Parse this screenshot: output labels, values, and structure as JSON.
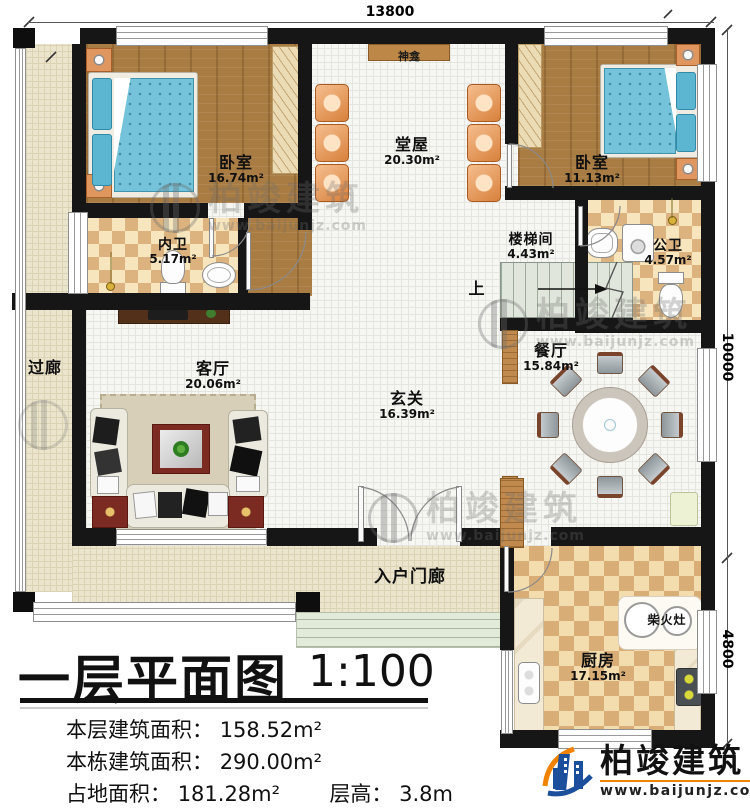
{
  "colors": {
    "wall": "#161616",
    "wood_floor": "#a87c42",
    "tile_light": "#f6e5bd",
    "tile_dark": "#dcb27f",
    "mattress_blue": "#74c3da",
    "logo_blue": "#1b4e9b",
    "logo_orange": "#f08300"
  },
  "dimensions": {
    "top": "13800",
    "right_upper": "10000",
    "right_lower": "4800"
  },
  "rooms": {
    "shrine": {
      "name": "神龛"
    },
    "hall": {
      "name": "堂屋",
      "area": "20.30m²"
    },
    "bedroom_left": {
      "name": "卧室",
      "area": "16.74m²"
    },
    "bedroom_right": {
      "name": "卧室",
      "area": "11.13m²"
    },
    "bath_inner": {
      "name": "内卫",
      "area": "5.17m²"
    },
    "stairwell": {
      "name": "楼梯间",
      "area": "4.43m²"
    },
    "bath_public": {
      "name": "公卫",
      "area": "4.57m²"
    },
    "corridor": {
      "name": "过廊"
    },
    "living": {
      "name": "客厅",
      "area": "20.06m²"
    },
    "foyer": {
      "name": "玄关",
      "area": "16.39m²"
    },
    "dining": {
      "name": "餐厅",
      "area": "15.84m²"
    },
    "porch": {
      "name": "入户门廊"
    },
    "kitchen": {
      "name": "厨房",
      "area": "17.15m²"
    },
    "wood_stove": {
      "name": "柴火灶"
    },
    "stairs_up": {
      "name": "上"
    }
  },
  "title": {
    "main": "一层平面图",
    "scale": "1:100"
  },
  "stats": {
    "line1_label": "本层建筑面积：",
    "line1_value": "158.52m²",
    "line2_label": "本栋建筑面积：",
    "line2_value": "290.00m²",
    "line3_label": "占地面积：",
    "line3_value": "181.28m²",
    "line3b_label": "层高：",
    "line3b_value": "3.8m"
  },
  "watermark": {
    "brand": "柏竣建筑",
    "url": "www.baijunjz.com"
  },
  "logo": {
    "brand": "柏竣建筑",
    "url": "www.baijunjz.com"
  }
}
